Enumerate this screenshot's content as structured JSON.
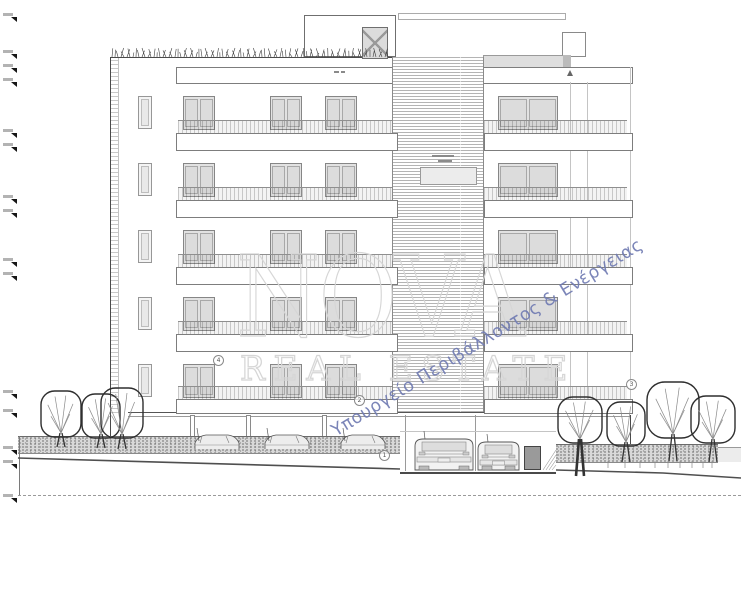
{
  "watermark": {
    "brand": "NOVA",
    "brand_sub": "REAL ESTATE",
    "diagonal_text": "Υπουργείο Περιβάλλοντος & Ενέργειας",
    "diagonal_color": "#707bb2",
    "outline_color": "#d6d6d6"
  },
  "colors": {
    "line_dark": "#4a4a4a",
    "line_mid": "#9a9a9a",
    "glazing": "#e2e2e2",
    "louver": "#b4b4b4",
    "ground_hatch": "#d9d9d9",
    "tree_stroke": "#2e2e2e"
  },
  "annotations": {
    "circled_labels": [
      {
        "label": "4",
        "x": 218,
        "y": 360
      },
      {
        "label": "2",
        "x": 359,
        "y": 400
      },
      {
        "label": "1",
        "x": 384,
        "y": 455
      },
      {
        "label": "3",
        "x": 631,
        "y": 384
      }
    ],
    "elevation_marker_ys": [
      13,
      50,
      64,
      78,
      129,
      143,
      195,
      209,
      258,
      272,
      390,
      409,
      446,
      460,
      494
    ]
  },
  "building": {
    "floors": 5,
    "floor_base_ys": [
      96,
      163,
      230,
      297,
      364
    ],
    "left_door_xs": [
      183,
      270,
      325
    ],
    "door_width": 32,
    "door_height": 34,
    "right_door_x": 498,
    "right_door_width": 60,
    "narrow_window_x": 138
  },
  "scene": {
    "left_trees": [
      {
        "cx": 61,
        "top": 391,
        "w": 40,
        "h": 46,
        "ground": 447,
        "trunk_big": false
      },
      {
        "cx": 101,
        "top": 394,
        "w": 38,
        "h": 44,
        "ground": 448,
        "trunk_big": false
      },
      {
        "cx": 122,
        "top": 388,
        "w": 42,
        "h": 50,
        "ground": 449,
        "trunk_big": false
      }
    ],
    "right_trees": [
      {
        "cx": 580,
        "top": 397,
        "w": 44,
        "h": 46,
        "ground": 476,
        "trunk_big": true
      },
      {
        "cx": 626,
        "top": 402,
        "w": 38,
        "h": 44,
        "ground": 462,
        "trunk_big": false
      },
      {
        "cx": 673,
        "top": 382,
        "w": 52,
        "h": 56,
        "ground": 461,
        "trunk_big": false
      },
      {
        "cx": 713,
        "top": 396,
        "w": 44,
        "h": 47,
        "ground": 462,
        "trunk_big": false
      }
    ],
    "wall_cars_cx": [
      218,
      288,
      364
    ],
    "garage_cars": [
      {
        "x": 415,
        "y": 437,
        "w": 58,
        "h": 33
      },
      {
        "x": 478,
        "y": 440,
        "w": 41,
        "h": 30
      }
    ],
    "ground_left_line": [
      [
        18,
        458
      ],
      [
        400,
        469
      ]
    ],
    "ground_right_line": [
      [
        556,
        470
      ],
      [
        663,
        473
      ],
      [
        741,
        478
      ]
    ]
  }
}
